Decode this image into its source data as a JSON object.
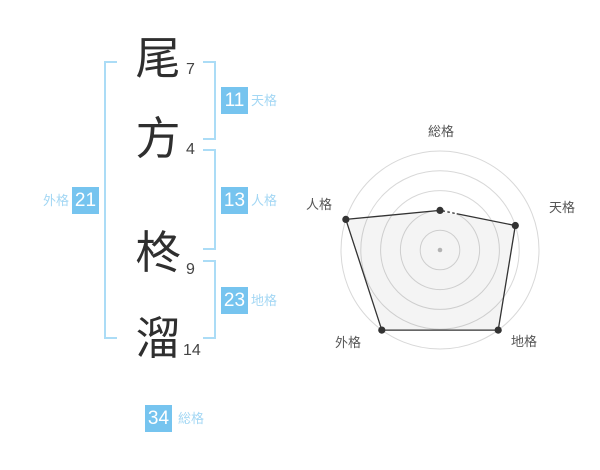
{
  "name": {
    "chars": [
      {
        "char": "尾",
        "strokes": "7"
      },
      {
        "char": "方",
        "strokes": "4"
      },
      {
        "char": "柊",
        "strokes": "9"
      },
      {
        "char": "溜",
        "strokes": "14"
      }
    ]
  },
  "categories": {
    "tenkaku": {
      "label": "天格",
      "value": "11"
    },
    "jinkaku": {
      "label": "人格",
      "value": "13"
    },
    "chikaku": {
      "label": "地格",
      "value": "23"
    },
    "gaikaku": {
      "label": "外格",
      "value": "21"
    },
    "soukaku": {
      "label": "総格",
      "value": "34"
    }
  },
  "chart_data": {
    "type": "radar",
    "categories": [
      "総格",
      "天格",
      "地格",
      "外格",
      "人格"
    ],
    "values": [
      2,
      4,
      5,
      5,
      5
    ],
    "max": 5,
    "rings": 5,
    "grid": "concentric-circles",
    "legend": "none"
  },
  "colors": {
    "accent_box": "#76c4ef",
    "label_blue": "#a3d7f4",
    "bracket_blue": "#abdcf6",
    "kanji_dark": "#2f2f2f",
    "stroke_number": "#444444",
    "ring_gray": "#d8d8d8",
    "polygon_stroke": "#333333",
    "polygon_fill": "rgba(0,0,0,0.045)",
    "point_dark": "#333333",
    "center_dot": "#b3b3b3",
    "radar_label": "#555555"
  }
}
